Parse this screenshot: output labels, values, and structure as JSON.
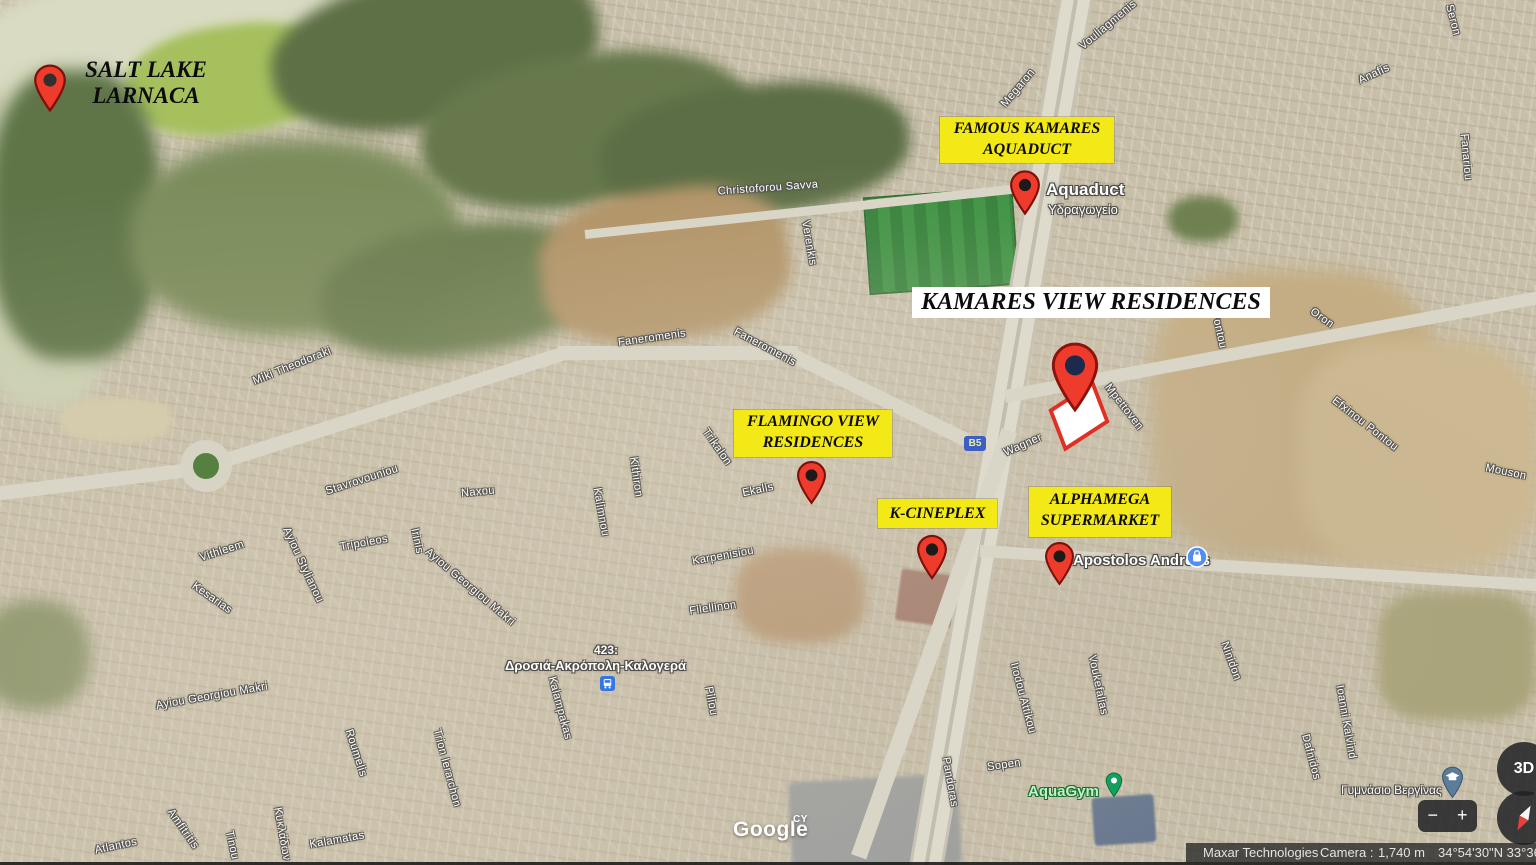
{
  "ui": {
    "logo": "Google",
    "logo_sup": "CY",
    "attribution": {
      "imagery": "Maxar Technologies",
      "camera": "Camera :",
      "distance": "1,740 m",
      "coords": "34°54'30\"N 33°36'09\""
    },
    "controls": {
      "three_d": "3D",
      "zoom_out": "−",
      "zoom_in": "+"
    }
  },
  "annotations": {
    "salt_lake": {
      "line1": "SALT LAKE",
      "line2": "LARNACA"
    },
    "aquaduct": {
      "line1": "FAMOUS KAMARES",
      "line2": "AQUADUCT"
    },
    "kamares": {
      "title": "KAMARES VIEW RESIDENCES"
    },
    "flamingo": {
      "line1": "FLAMINGO VIEW",
      "line2": "RESIDENCES"
    },
    "kcineplex": {
      "title": "K-CINEPLEX"
    },
    "alphamega": {
      "line1": "ALPHAMEGA",
      "line2": "SUPERMARKET"
    }
  },
  "places": {
    "aquaduct_name": "Aquaduct",
    "aquaduct_name_el": "Υδραγωγείο",
    "apostolos": "Apostolos Andreas",
    "school": "Γυμνάσιο Βεργίνας",
    "aquagym": "AquaGym",
    "bus_code": "423:",
    "bus_name": "Δροσιά-Ακρόπολη-Καλογερά",
    "road_badge": "B5"
  },
  "street_labels": [
    {
      "t": "Christoforou Savva",
      "x": 768,
      "y": 188,
      "r": -4
    },
    {
      "t": "Verenkis",
      "x": 809,
      "y": 243,
      "r": 80
    },
    {
      "t": "Faneromenis",
      "x": 652,
      "y": 338,
      "r": -8
    },
    {
      "t": "Faneromenis",
      "x": 765,
      "y": 347,
      "r": 28
    },
    {
      "t": "Miki Theodoraki",
      "x": 292,
      "y": 366,
      "r": -22
    },
    {
      "t": "Stavrovouniou",
      "x": 362,
      "y": 480,
      "r": -18
    },
    {
      "t": "Naxou",
      "x": 478,
      "y": 492,
      "r": -5
    },
    {
      "t": "Vithleem",
      "x": 222,
      "y": 551,
      "r": -18
    },
    {
      "t": "Ayiou Stylianou",
      "x": 303,
      "y": 565,
      "r": 65
    },
    {
      "t": "Kesarias",
      "x": 212,
      "y": 598,
      "r": 35
    },
    {
      "t": "Tripoleos",
      "x": 364,
      "y": 543,
      "r": -10
    },
    {
      "t": "Irinis",
      "x": 417,
      "y": 541,
      "r": 78
    },
    {
      "t": "Ayiou Georgiou Makri",
      "x": 470,
      "y": 587,
      "r": 40
    },
    {
      "t": "Kalimnou",
      "x": 601,
      "y": 512,
      "r": 80
    },
    {
      "t": "Kithiron",
      "x": 636,
      "y": 477,
      "r": 82
    },
    {
      "t": "Trikalon",
      "x": 717,
      "y": 447,
      "r": 55
    },
    {
      "t": "Ekalis",
      "x": 758,
      "y": 490,
      "r": -12
    },
    {
      "t": "Karpenisiou",
      "x": 723,
      "y": 556,
      "r": -10
    },
    {
      "t": "Filellinon",
      "x": 713,
      "y": 608,
      "r": -8
    },
    {
      "t": "Piliou",
      "x": 711,
      "y": 701,
      "r": 80
    },
    {
      "t": "Kalampakas",
      "x": 560,
      "y": 708,
      "r": 75
    },
    {
      "t": "Ayiou Georgiou Makri",
      "x": 212,
      "y": 696,
      "r": -10
    },
    {
      "t": "Roumelis",
      "x": 356,
      "y": 753,
      "r": 72
    },
    {
      "t": "Trion Ierarchon",
      "x": 447,
      "y": 768,
      "r": 75
    },
    {
      "t": "Amfitritis",
      "x": 183,
      "y": 829,
      "r": 55
    },
    {
      "t": "Atlantos",
      "x": 116,
      "y": 846,
      "r": -12
    },
    {
      "t": "Tinou",
      "x": 232,
      "y": 845,
      "r": 78
    },
    {
      "t": "Κυκλάδων",
      "x": 282,
      "y": 834,
      "r": 80
    },
    {
      "t": "Kalamatas",
      "x": 337,
      "y": 840,
      "r": -10
    },
    {
      "t": "Wagner",
      "x": 1023,
      "y": 445,
      "r": -24
    },
    {
      "t": "Mpettoven",
      "x": 1124,
      "y": 407,
      "r": 52
    },
    {
      "t": "Pontou",
      "x": 1219,
      "y": 330,
      "r": 78
    },
    {
      "t": "Oron",
      "x": 1322,
      "y": 318,
      "r": 35
    },
    {
      "t": "Efxinou Pontou",
      "x": 1365,
      "y": 424,
      "r": 38
    },
    {
      "t": "Mouson",
      "x": 1506,
      "y": 472,
      "r": 12
    },
    {
      "t": "Fanariou",
      "x": 1466,
      "y": 157,
      "r": 85
    },
    {
      "t": "Anafis",
      "x": 1374,
      "y": 74,
      "r": -25
    },
    {
      "t": "Vouliagmenis",
      "x": 1108,
      "y": 25,
      "r": -40
    },
    {
      "t": "Megaron",
      "x": 1018,
      "y": 88,
      "r": -50
    },
    {
      "t": "Seron",
      "x": 1453,
      "y": 20,
      "r": 75
    },
    {
      "t": "Voukefalias",
      "x": 1098,
      "y": 685,
      "r": 78
    },
    {
      "t": "Irodou Attikou",
      "x": 1023,
      "y": 698,
      "r": 75
    },
    {
      "t": "Ninidon",
      "x": 1231,
      "y": 661,
      "r": 70
    },
    {
      "t": "Pandoras",
      "x": 950,
      "y": 782,
      "r": 80
    },
    {
      "t": "Sopen",
      "x": 1004,
      "y": 765,
      "r": -8
    },
    {
      "t": "Dafnidos",
      "x": 1311,
      "y": 757,
      "r": 75
    },
    {
      "t": "Ioanni Kalvind",
      "x": 1346,
      "y": 722,
      "r": 80
    }
  ]
}
